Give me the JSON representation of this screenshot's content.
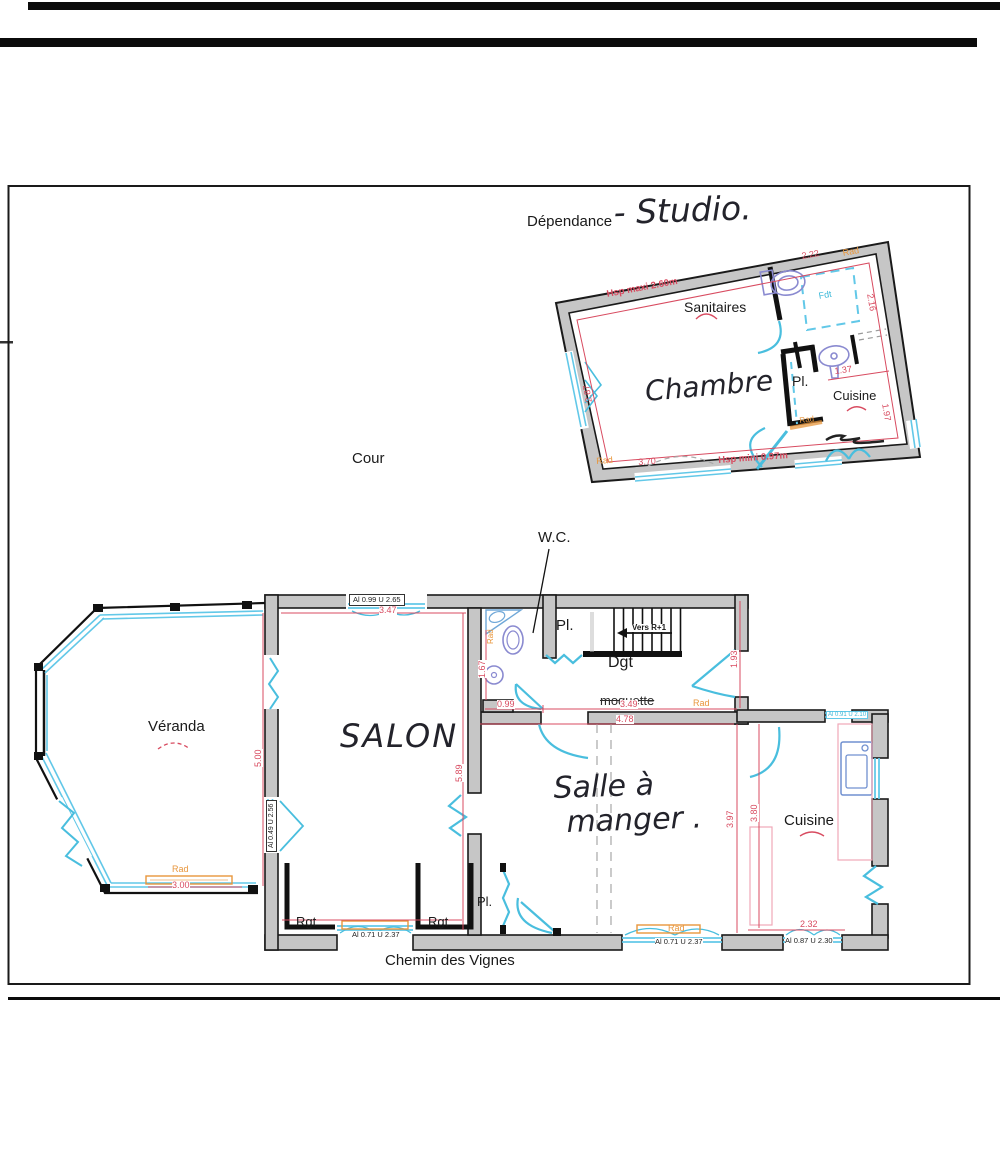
{
  "document": {
    "header_printed": "Dépendance",
    "header_handwritten": "- Studio.",
    "courtyard_label": "Cour",
    "wc_label": "W.C.",
    "street_label": "Chemin des Vignes"
  },
  "studio": {
    "sanitaires": "Sanitaires",
    "chambre": "Chambre",
    "closet": "Pl.",
    "cuisine": "Cuisine",
    "skylight": "Fdt",
    "note_height_max": "Hsp maxi 2.60m",
    "note_height_min": "Hsp mini 0.97m",
    "radiator": "Rad",
    "dims": {
      "top_right": "2.22",
      "right": "2.16",
      "left": "2.87",
      "bottom": "3.70",
      "cuisine_width": "1.37",
      "cuisine_height": "1.97"
    }
  },
  "house": {
    "veranda": "Véranda",
    "salon": "SALON",
    "dining_line1": "Salle à",
    "dining_line2": "manger .",
    "cuisine": "Cuisine",
    "hall": "Dgt",
    "closet_top": "Pl.",
    "closet_bottom": "Pl.",
    "storage_left": "Rgt",
    "storage_right": "Rgt",
    "stairs_note": "Vers R+1",
    "floor_note": "moquette",
    "radiator": "Rad",
    "dims": {
      "salon_top": "3.47",
      "veranda_height": "5.00",
      "salon_height": "5.89",
      "wc_width": "0.99",
      "wc_height": "1.67",
      "hall_width": "3.49",
      "hall_height": "1.93",
      "dining_width": "4.78",
      "dining_height": "3.97",
      "cuisine_height": "3.80",
      "cuisine_width": "2.32",
      "veranda_width": "3.00"
    },
    "windows": {
      "salon_top": "Al 0.99  U 2.65",
      "salon_left": "Al 0.49  U 2.56",
      "salon_bottom": "Al 0.71  U 2.37",
      "dining_bottom": "Al 0.71  U 2.37",
      "cuisine_bottom": "Al 0.87  U 2.30",
      "cuisine_top": "Al 0.91 U 2.10"
    }
  },
  "colors": {
    "dimension_red": "#d84b60",
    "radiator_orange": "#e8963c",
    "window_cyan": "#62c8e8",
    "fixture_blue": "#8a8ad0",
    "wall_gray": "#c6c6c6"
  }
}
